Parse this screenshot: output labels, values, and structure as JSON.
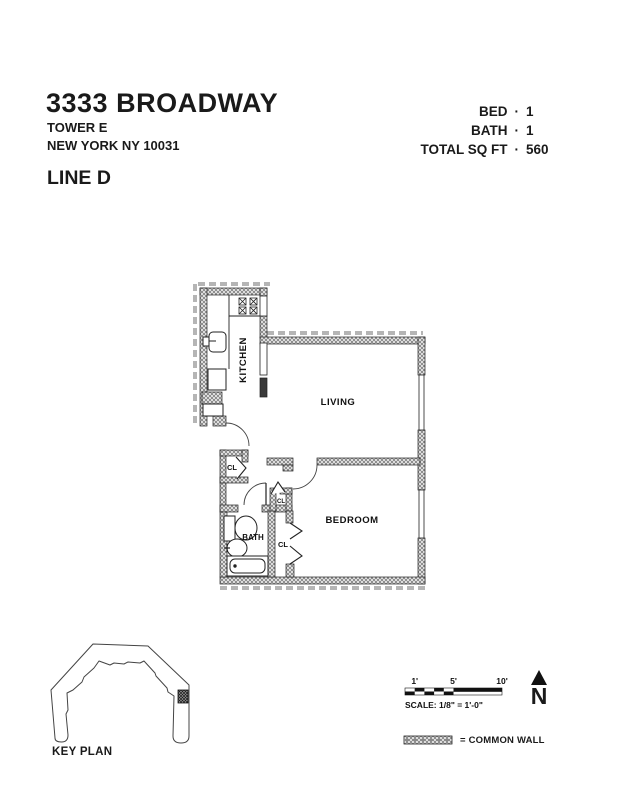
{
  "header": {
    "title": "3333 BROADWAY",
    "address_line1": "TOWER E",
    "address_line2": "NEW YORK NY 10031",
    "unit_line": "LINE D",
    "stat_separator": "·",
    "stats": [
      {
        "label": "BED",
        "value": "1"
      },
      {
        "label": "BATH",
        "value": "1"
      },
      {
        "label": "TOTAL SQ FT",
        "value": "560"
      }
    ]
  },
  "floorplan": {
    "labels": {
      "kitchen": "KITCHEN",
      "living": "LIVING",
      "bedroom": "BEDROOM",
      "bath": "BATH",
      "hall_closet": "CL",
      "entry_closet": "CL",
      "bedroom_closet": "CL"
    }
  },
  "footer": {
    "key_plan_label": "KEY PLAN",
    "scale_bar": {
      "tick_1": "1'",
      "tick_5": "5'",
      "tick_10": "10'",
      "caption": "SCALE: 1/8\" = 1'-0\""
    },
    "north_label": "N",
    "legend_text": "= COMMON WALL"
  },
  "colors": {
    "ink": "#1a1a1a",
    "wall_hatch": "#6f6f6f",
    "common_wall_dash": "#b5b5b5"
  }
}
